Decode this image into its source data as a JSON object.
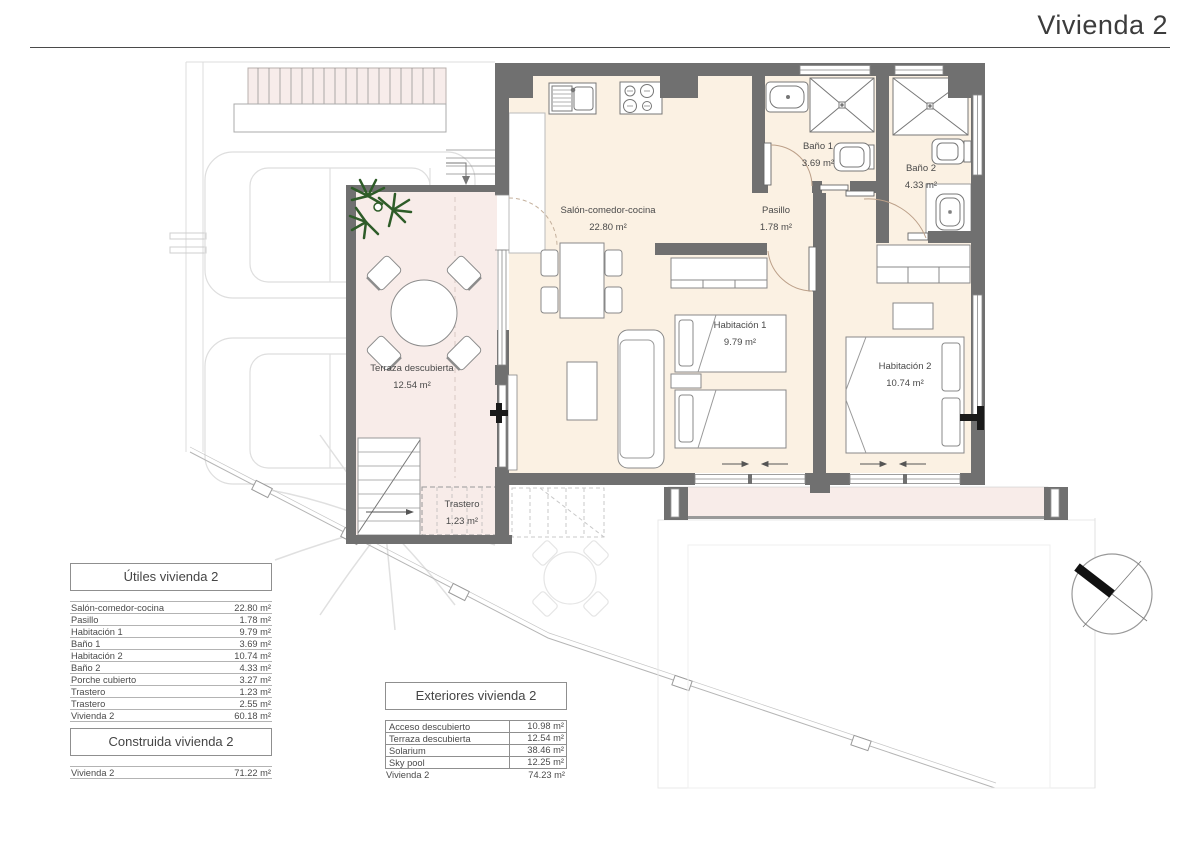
{
  "title": "Vivienda 2",
  "colors": {
    "wall": "#707070",
    "interior_floor": "#fbf1e3",
    "terrace_floor": "#f8ece9",
    "palm_green": "#2e5c28",
    "north_arrow": "#111111"
  },
  "plan": {
    "rooms": [
      {
        "name": "Salón-comedor-cocina",
        "area": "22.80 m²"
      },
      {
        "name": "Pasillo",
        "area": "1.78 m²"
      },
      {
        "name": "Baño 1",
        "area": "3.69 m²"
      },
      {
        "name": "Baño 2",
        "area": "4.33 m²"
      },
      {
        "name": "Habitación 1",
        "area": "9.79 m²"
      },
      {
        "name": "Habitación 2",
        "area": "10.74 m²"
      },
      {
        "name": "Terraza descubierta",
        "area": "12.54 m²"
      },
      {
        "name": "Trastero",
        "area": "1.23 m²"
      }
    ]
  },
  "tables": {
    "utiles": {
      "title": "Útiles vivienda 2",
      "rows": [
        {
          "label": "Salón-comedor-cocina",
          "value": "22.80 m²"
        },
        {
          "label": "Pasillo",
          "value": "1.78 m²"
        },
        {
          "label": "Habitación 1",
          "value": "9.79 m²"
        },
        {
          "label": "Baño 1",
          "value": "3.69 m²"
        },
        {
          "label": "Habitación 2",
          "value": "10.74 m²"
        },
        {
          "label": "Baño 2",
          "value": "4.33 m²"
        },
        {
          "label": "Porche cubierto",
          "value": "3.27 m²"
        },
        {
          "label": "Trastero",
          "value": "1.23 m²"
        },
        {
          "label": "Trastero",
          "value": "2.55 m²"
        },
        {
          "label": "Vivienda 2",
          "value": "60.18 m²"
        }
      ]
    },
    "construida": {
      "title": "Construida vivienda 2",
      "rows": [
        {
          "label": "Vivienda 2",
          "value": "71.22 m²"
        }
      ]
    },
    "exteriores": {
      "title": "Exteriores vivienda 2",
      "rows": [
        {
          "label": "Acceso descubierto",
          "value": "10.98 m²"
        },
        {
          "label": "Terraza descubierta",
          "value": "12.54 m²"
        },
        {
          "label": "Solarium",
          "value": "38.46 m²"
        },
        {
          "label": "Sky pool",
          "value": "12.25 m²"
        }
      ],
      "total": {
        "label": "Vivienda 2",
        "value": "74.23 m²"
      }
    }
  }
}
